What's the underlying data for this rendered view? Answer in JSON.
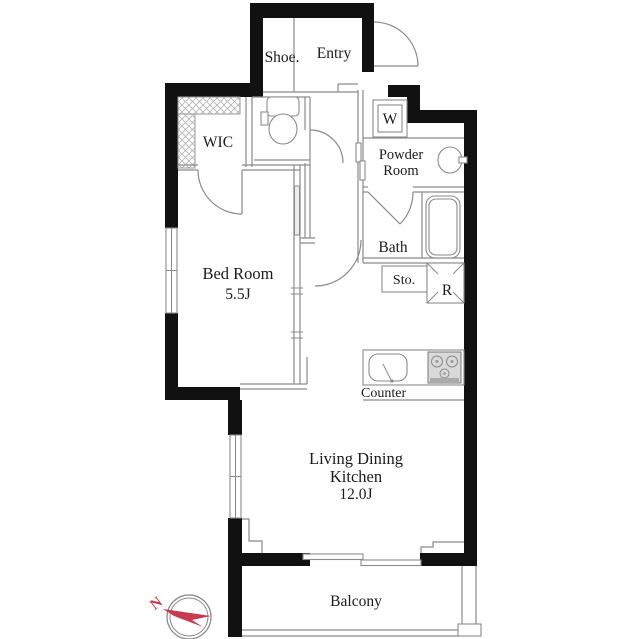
{
  "title": "Apartment floor plan",
  "rooms": {
    "entry": {
      "label": "Entry"
    },
    "shoe": {
      "label": "Shoe."
    },
    "wic": {
      "label": "WIC"
    },
    "washer": {
      "label": "W"
    },
    "powder_room": {
      "line1": "Powder",
      "line2": "Room"
    },
    "bath": {
      "label": "Bath"
    },
    "storage": {
      "label": "Sto."
    },
    "refrigerator": {
      "label": "R"
    },
    "bedroom": {
      "label": "Bed Room",
      "area": "5.5J"
    },
    "kitchen_counter": {
      "label": "Counter"
    },
    "ldk": {
      "line1": "Living Dining",
      "line2": "Kitchen",
      "area": "12.0J"
    },
    "balcony": {
      "label": "Balcony"
    }
  },
  "compass": {
    "north_label": "N"
  },
  "colors": {
    "wall": "#111111",
    "line": "#8a8a8a",
    "text": "#1b1b1b",
    "compass_red": "#c83a50",
    "stove_fill": "#d9d9d9"
  }
}
